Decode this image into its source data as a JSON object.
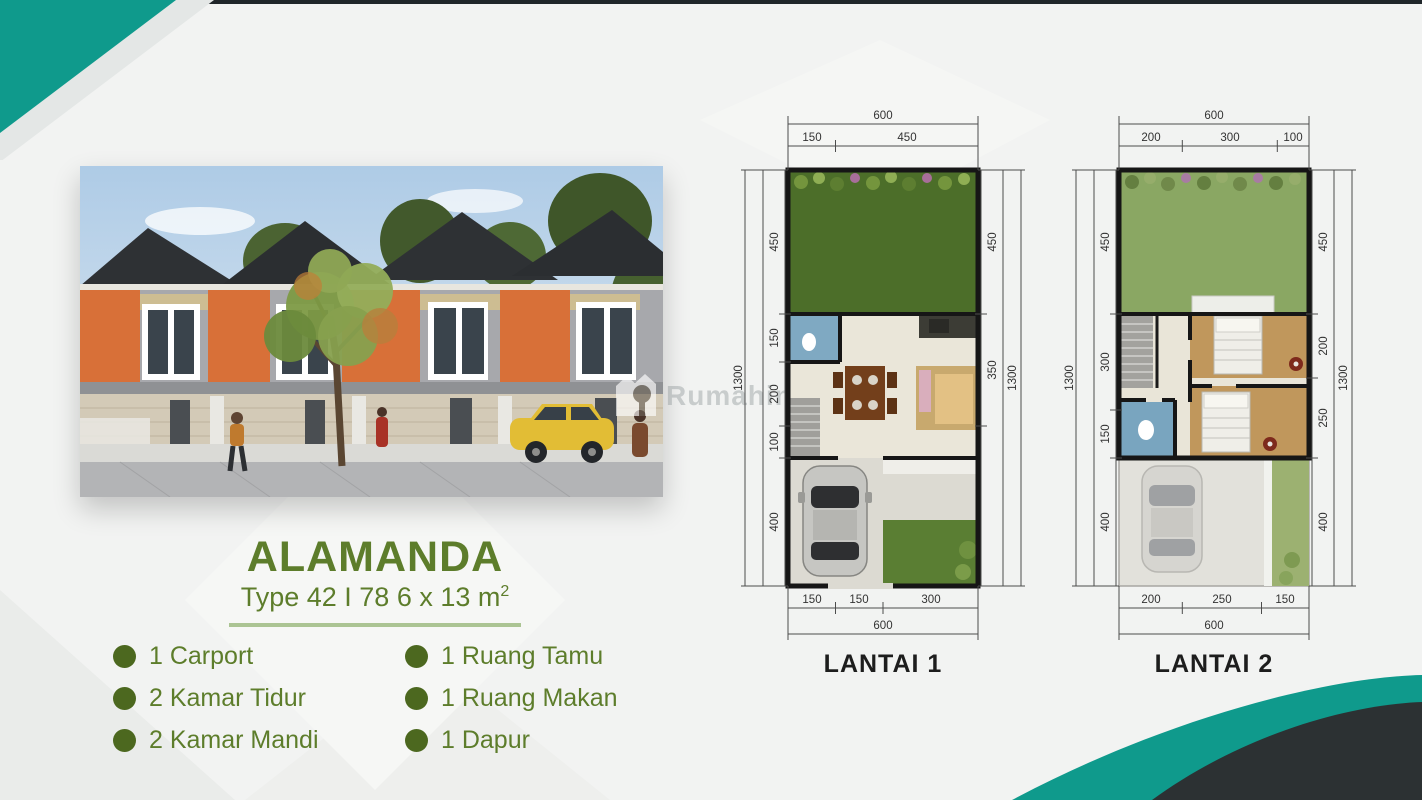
{
  "project": {
    "title": "ALAMANDA",
    "type_label": "Type 42 I 78 6 x 13 m",
    "type_sup": "2",
    "features_left": [
      "1 Carport",
      "2 Kamar Tidur",
      "2 Kamar Mandi"
    ],
    "features_right": [
      "1 Ruang Tamu",
      "1 Ruang Makan",
      "1 Dapur"
    ]
  },
  "watermark": {
    "text": "Rumahindo"
  },
  "floorplans": [
    {
      "label": "LANTAI 1",
      "dims": {
        "top_total": "600",
        "top_segments": [
          "150",
          "450"
        ],
        "bottom_segments": [
          "150",
          "150",
          "300"
        ],
        "bottom_total": "600",
        "left_total": "1300",
        "left_segments": [
          "450",
          "150",
          "200",
          "100",
          "400"
        ],
        "right_total": "1300",
        "right_segments": [
          "450",
          "350"
        ]
      }
    },
    {
      "label": "LANTAI 2",
      "dims": {
        "top_total": "600",
        "top_segments": [
          "200",
          "300",
          "100"
        ],
        "bottom_segments": [
          "200",
          "250",
          "150"
        ],
        "bottom_total": "600",
        "left_total": "1300",
        "left_segments": [
          "450",
          "300",
          "150",
          "400"
        ],
        "right_total": "1300",
        "right_segments": [
          "450",
          "200",
          "250",
          "400"
        ]
      }
    }
  ],
  "colors": {
    "accent_teal": "#0f9a8c",
    "accent_dark": "#2c3133",
    "olive_text": "#5d7d2b",
    "divider": "#abc493"
  }
}
